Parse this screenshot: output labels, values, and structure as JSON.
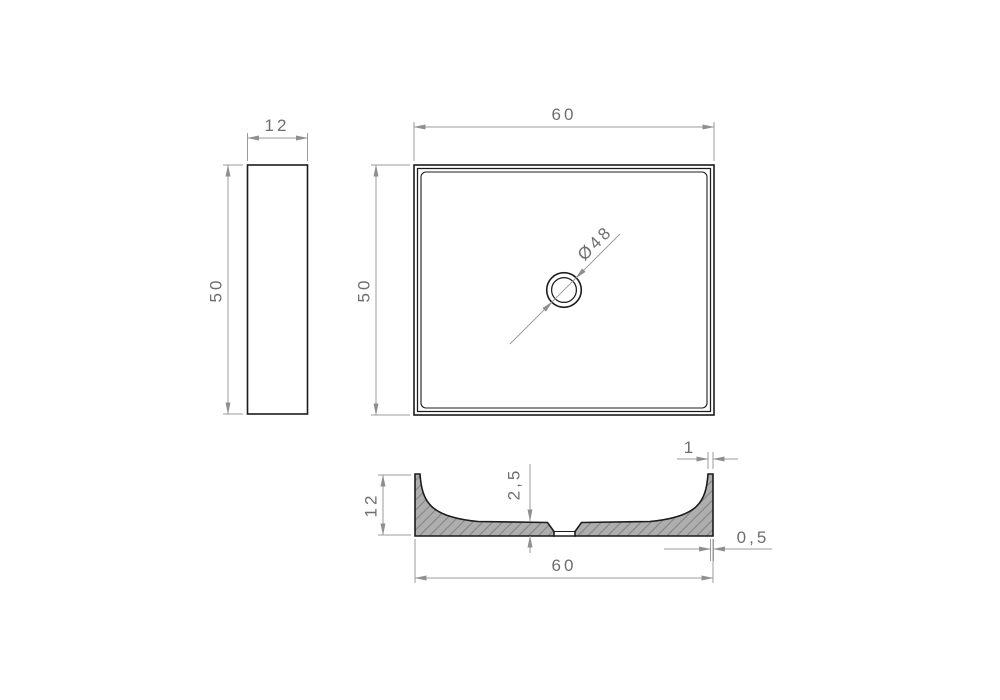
{
  "drawing": {
    "type": "technical-orthographic-drawing",
    "views": {
      "side_view": {
        "width": "12",
        "height": "50"
      },
      "top_view": {
        "width": "60",
        "height": "50",
        "drain_diameter": "Ø48"
      },
      "section_view": {
        "height": "12",
        "width": "60",
        "floor_thickness": "2,5",
        "rim_wall_thickness": "1",
        "bottom_edge_offset": "0,5"
      }
    },
    "colors": {
      "background": "#ffffff",
      "object_line": "#1c1c1c",
      "dimension_line": "#9b9b9b",
      "dimension_text": "#6e6e6e",
      "arrowhead": "#8f8f8f",
      "hatch_fill": "#aeaeae",
      "hatch_line": "#848484"
    }
  }
}
